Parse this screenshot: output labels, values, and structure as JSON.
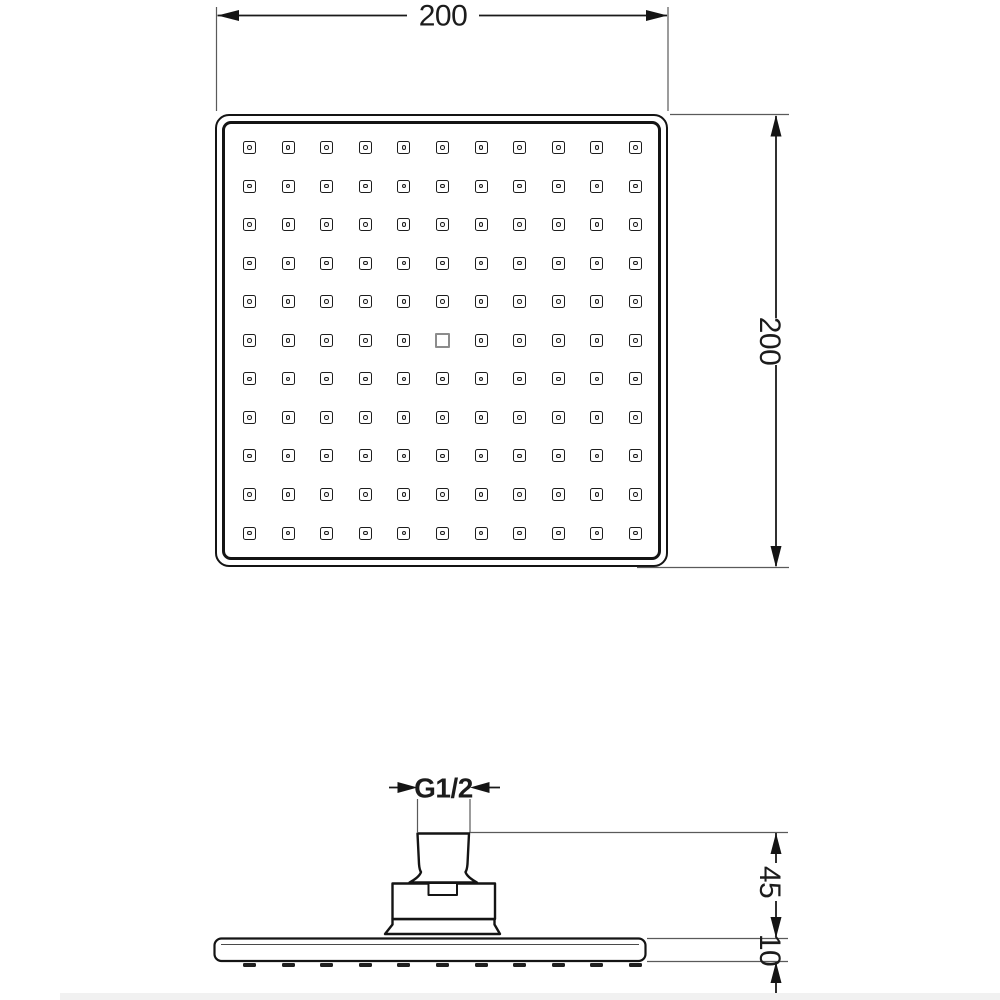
{
  "drawing": {
    "dimensions": {
      "top_width": "200",
      "right_height": "200",
      "thread": "G1/2",
      "mount_height": "45",
      "plate_thickness": "10"
    },
    "top_view": {
      "nozzle_rows": 11,
      "nozzle_cols": 11,
      "center_element": "plain-square-nozzle"
    },
    "side_view": {
      "spray_dashes": 11
    },
    "colors": {
      "line": "#1a1a1a",
      "background": "#ffffff",
      "center_nozzle_border": "#8c8c8c"
    }
  }
}
